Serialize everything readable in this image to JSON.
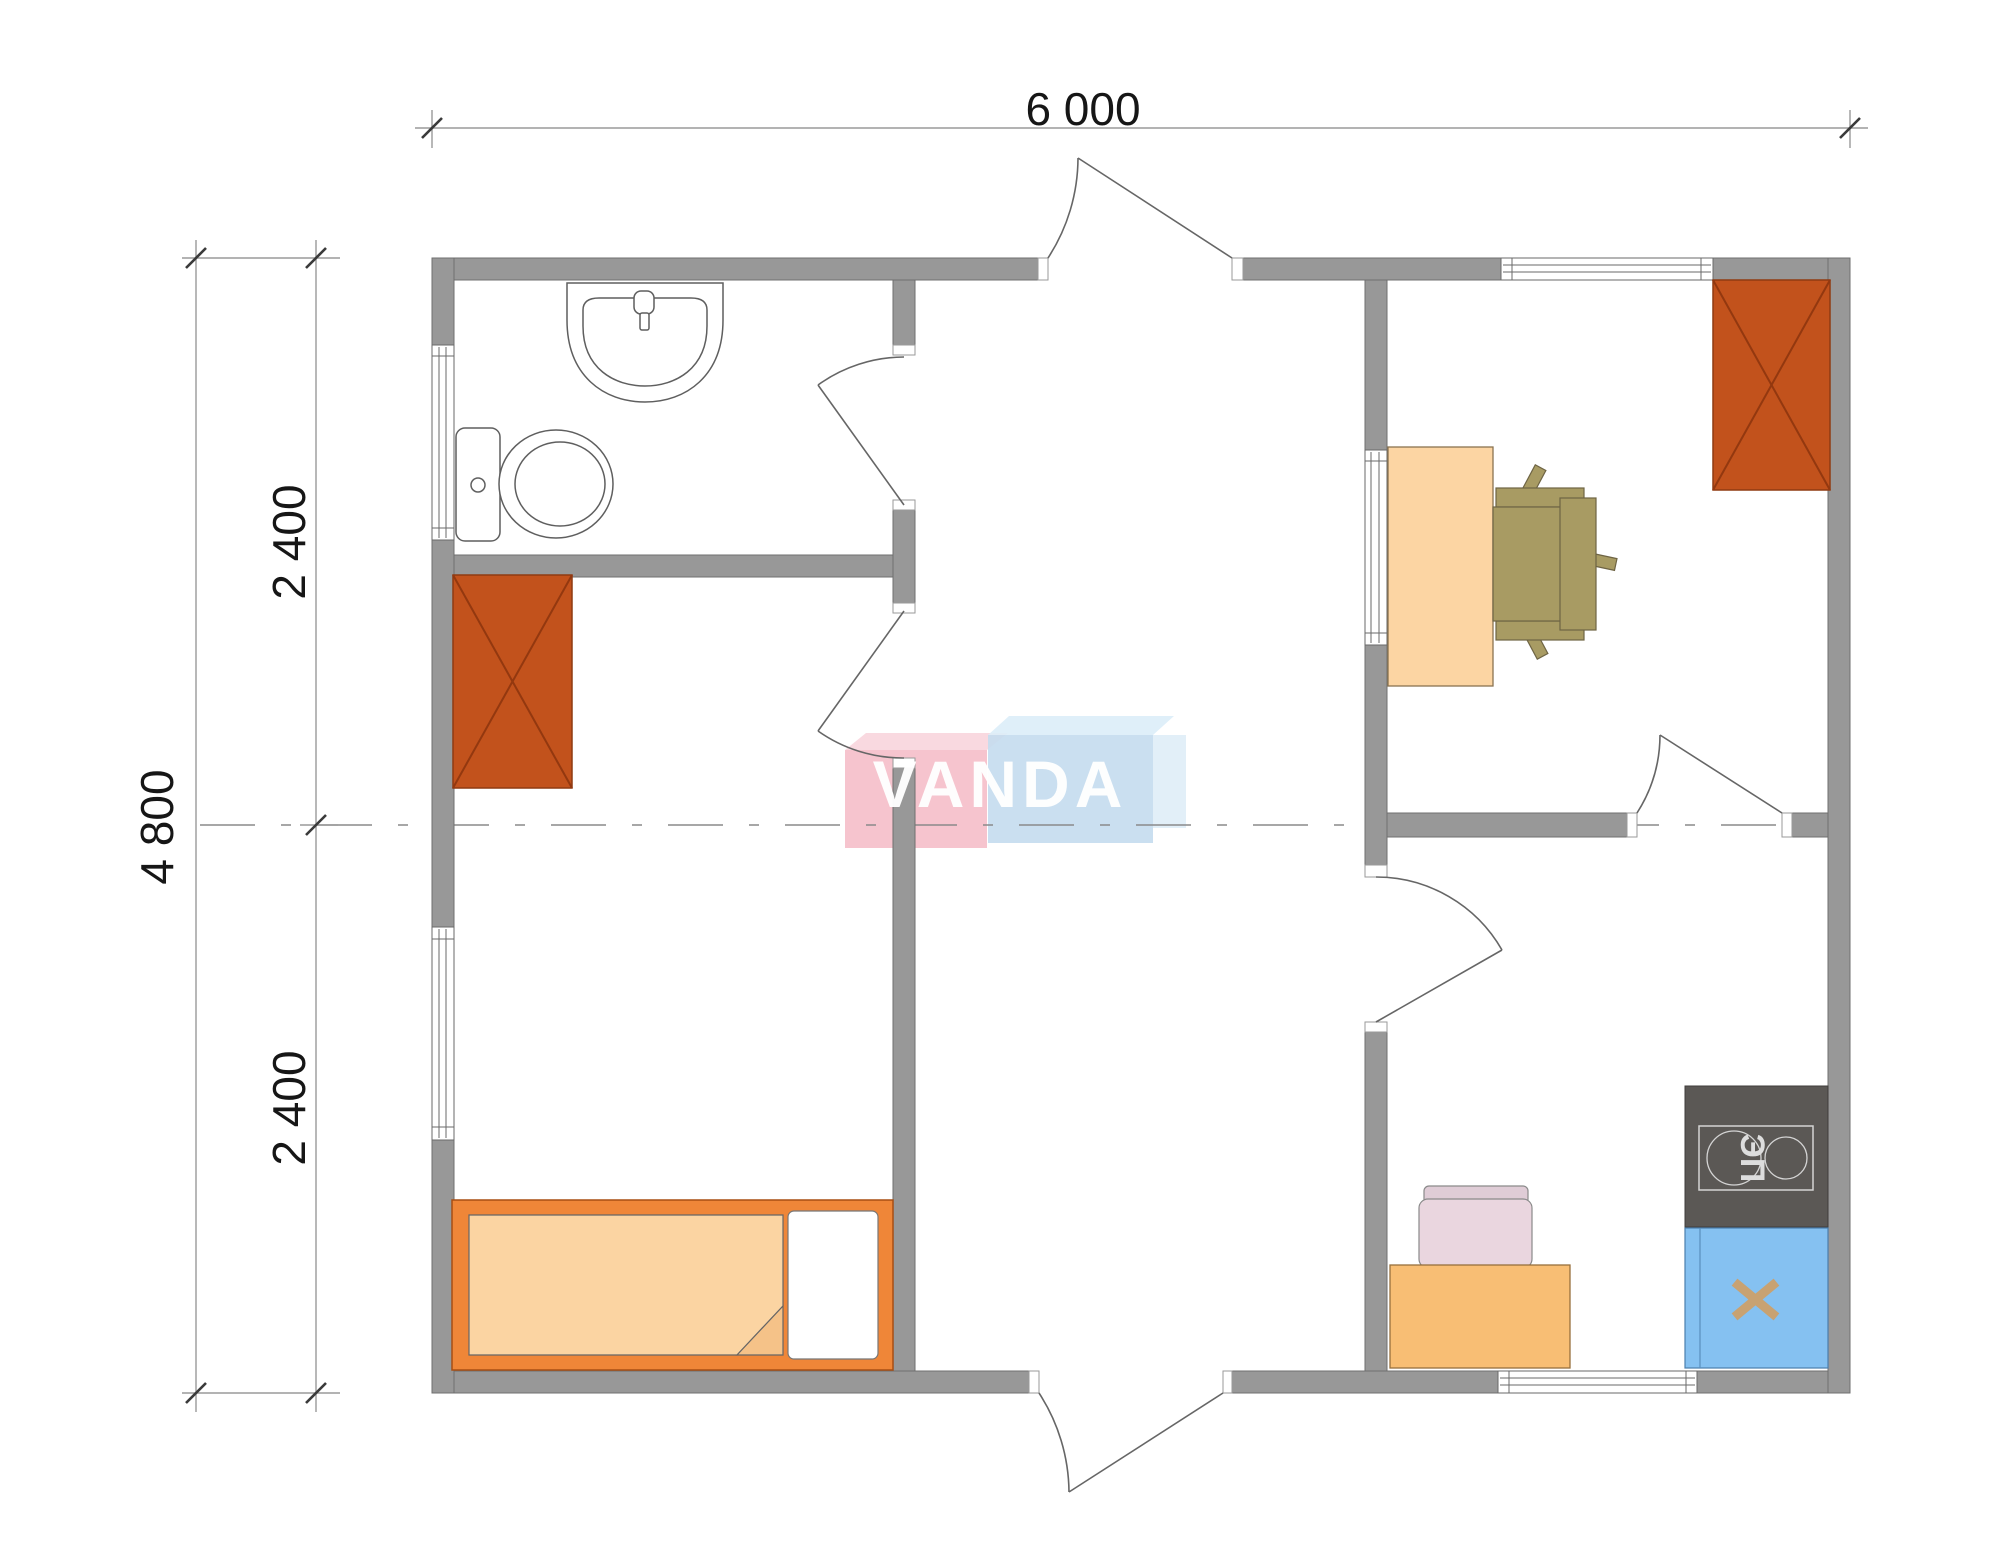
{
  "dimensions": {
    "top": {
      "label": "6 000"
    },
    "left_total": {
      "label": "4 800"
    },
    "left_upper": {
      "label": "2 400"
    },
    "left_lower": {
      "label": "2 400"
    }
  },
  "watermark": {
    "text": "VANDA",
    "pink_color": "#F4BAC5",
    "blue_color": "#C4DCEE"
  },
  "kitchen": {
    "stove_label": "ЭП"
  },
  "colors": {
    "wall": "#989898",
    "wall_edge": "#6f6f6f",
    "wardrobe": "#C2521C",
    "wardrobe_line": "#93380F",
    "bed_frame": "#EF8638",
    "bed_blanket": "#FBD4A2",
    "desk": "#FCD5A3",
    "office_chair": "#A89B63",
    "kitchen_table": "#F8BE74",
    "kitchen_chair": "#EAD6DF",
    "stove": "#5B5855",
    "sink_cabinet": "#85C1F1",
    "x_mark": "#C8A272"
  }
}
